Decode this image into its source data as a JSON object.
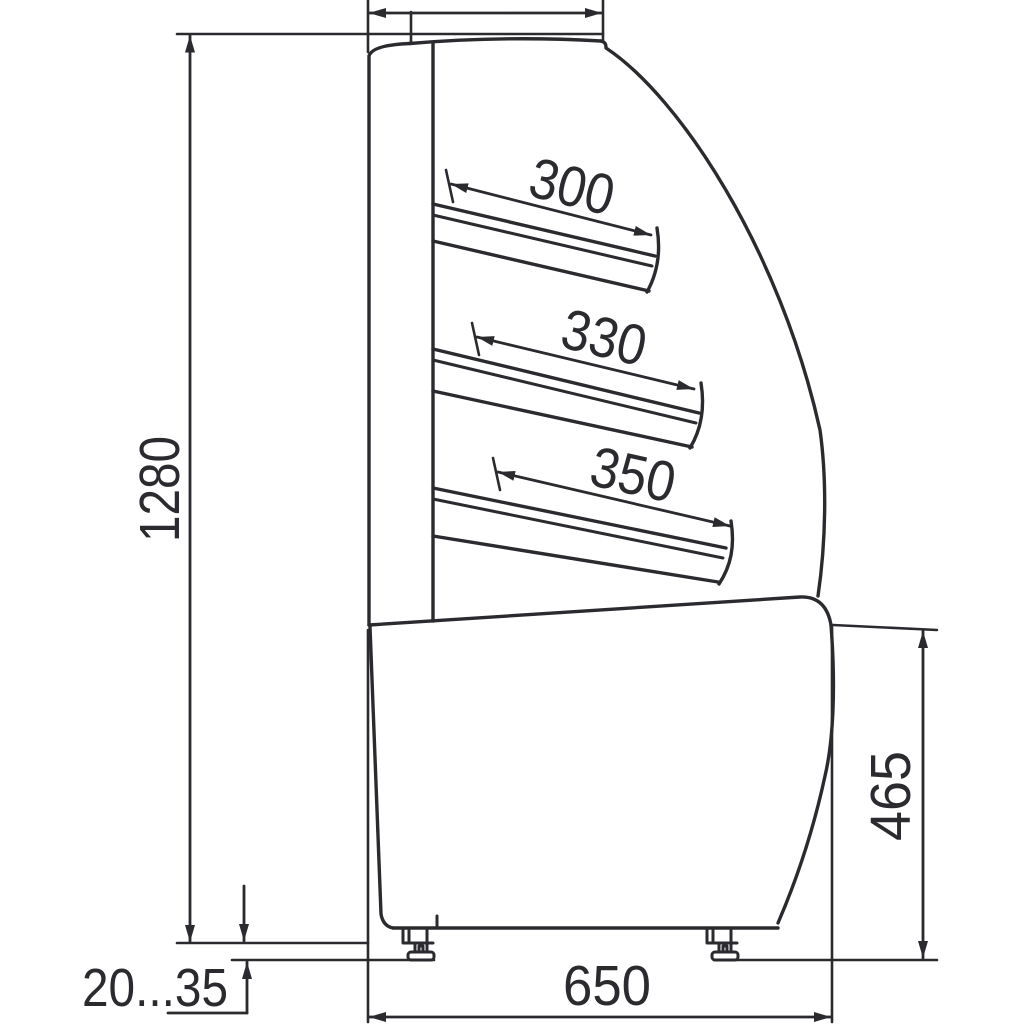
{
  "drawing": {
    "description": "Technical side-view dimensional drawing of a curved-glass confectionery display case with three sloped shelves and adjustable feet",
    "background_color": "#ffffff",
    "line_color": "#2b2b2f",
    "labels": {
      "overall_height": "1280",
      "shelf_1_depth": "300",
      "shelf_2_depth": "330",
      "shelf_3_depth": "350",
      "base_height": "465",
      "base_depth": "650",
      "foot_adjust_range": "20...35",
      "top_depth": ""
    }
  }
}
